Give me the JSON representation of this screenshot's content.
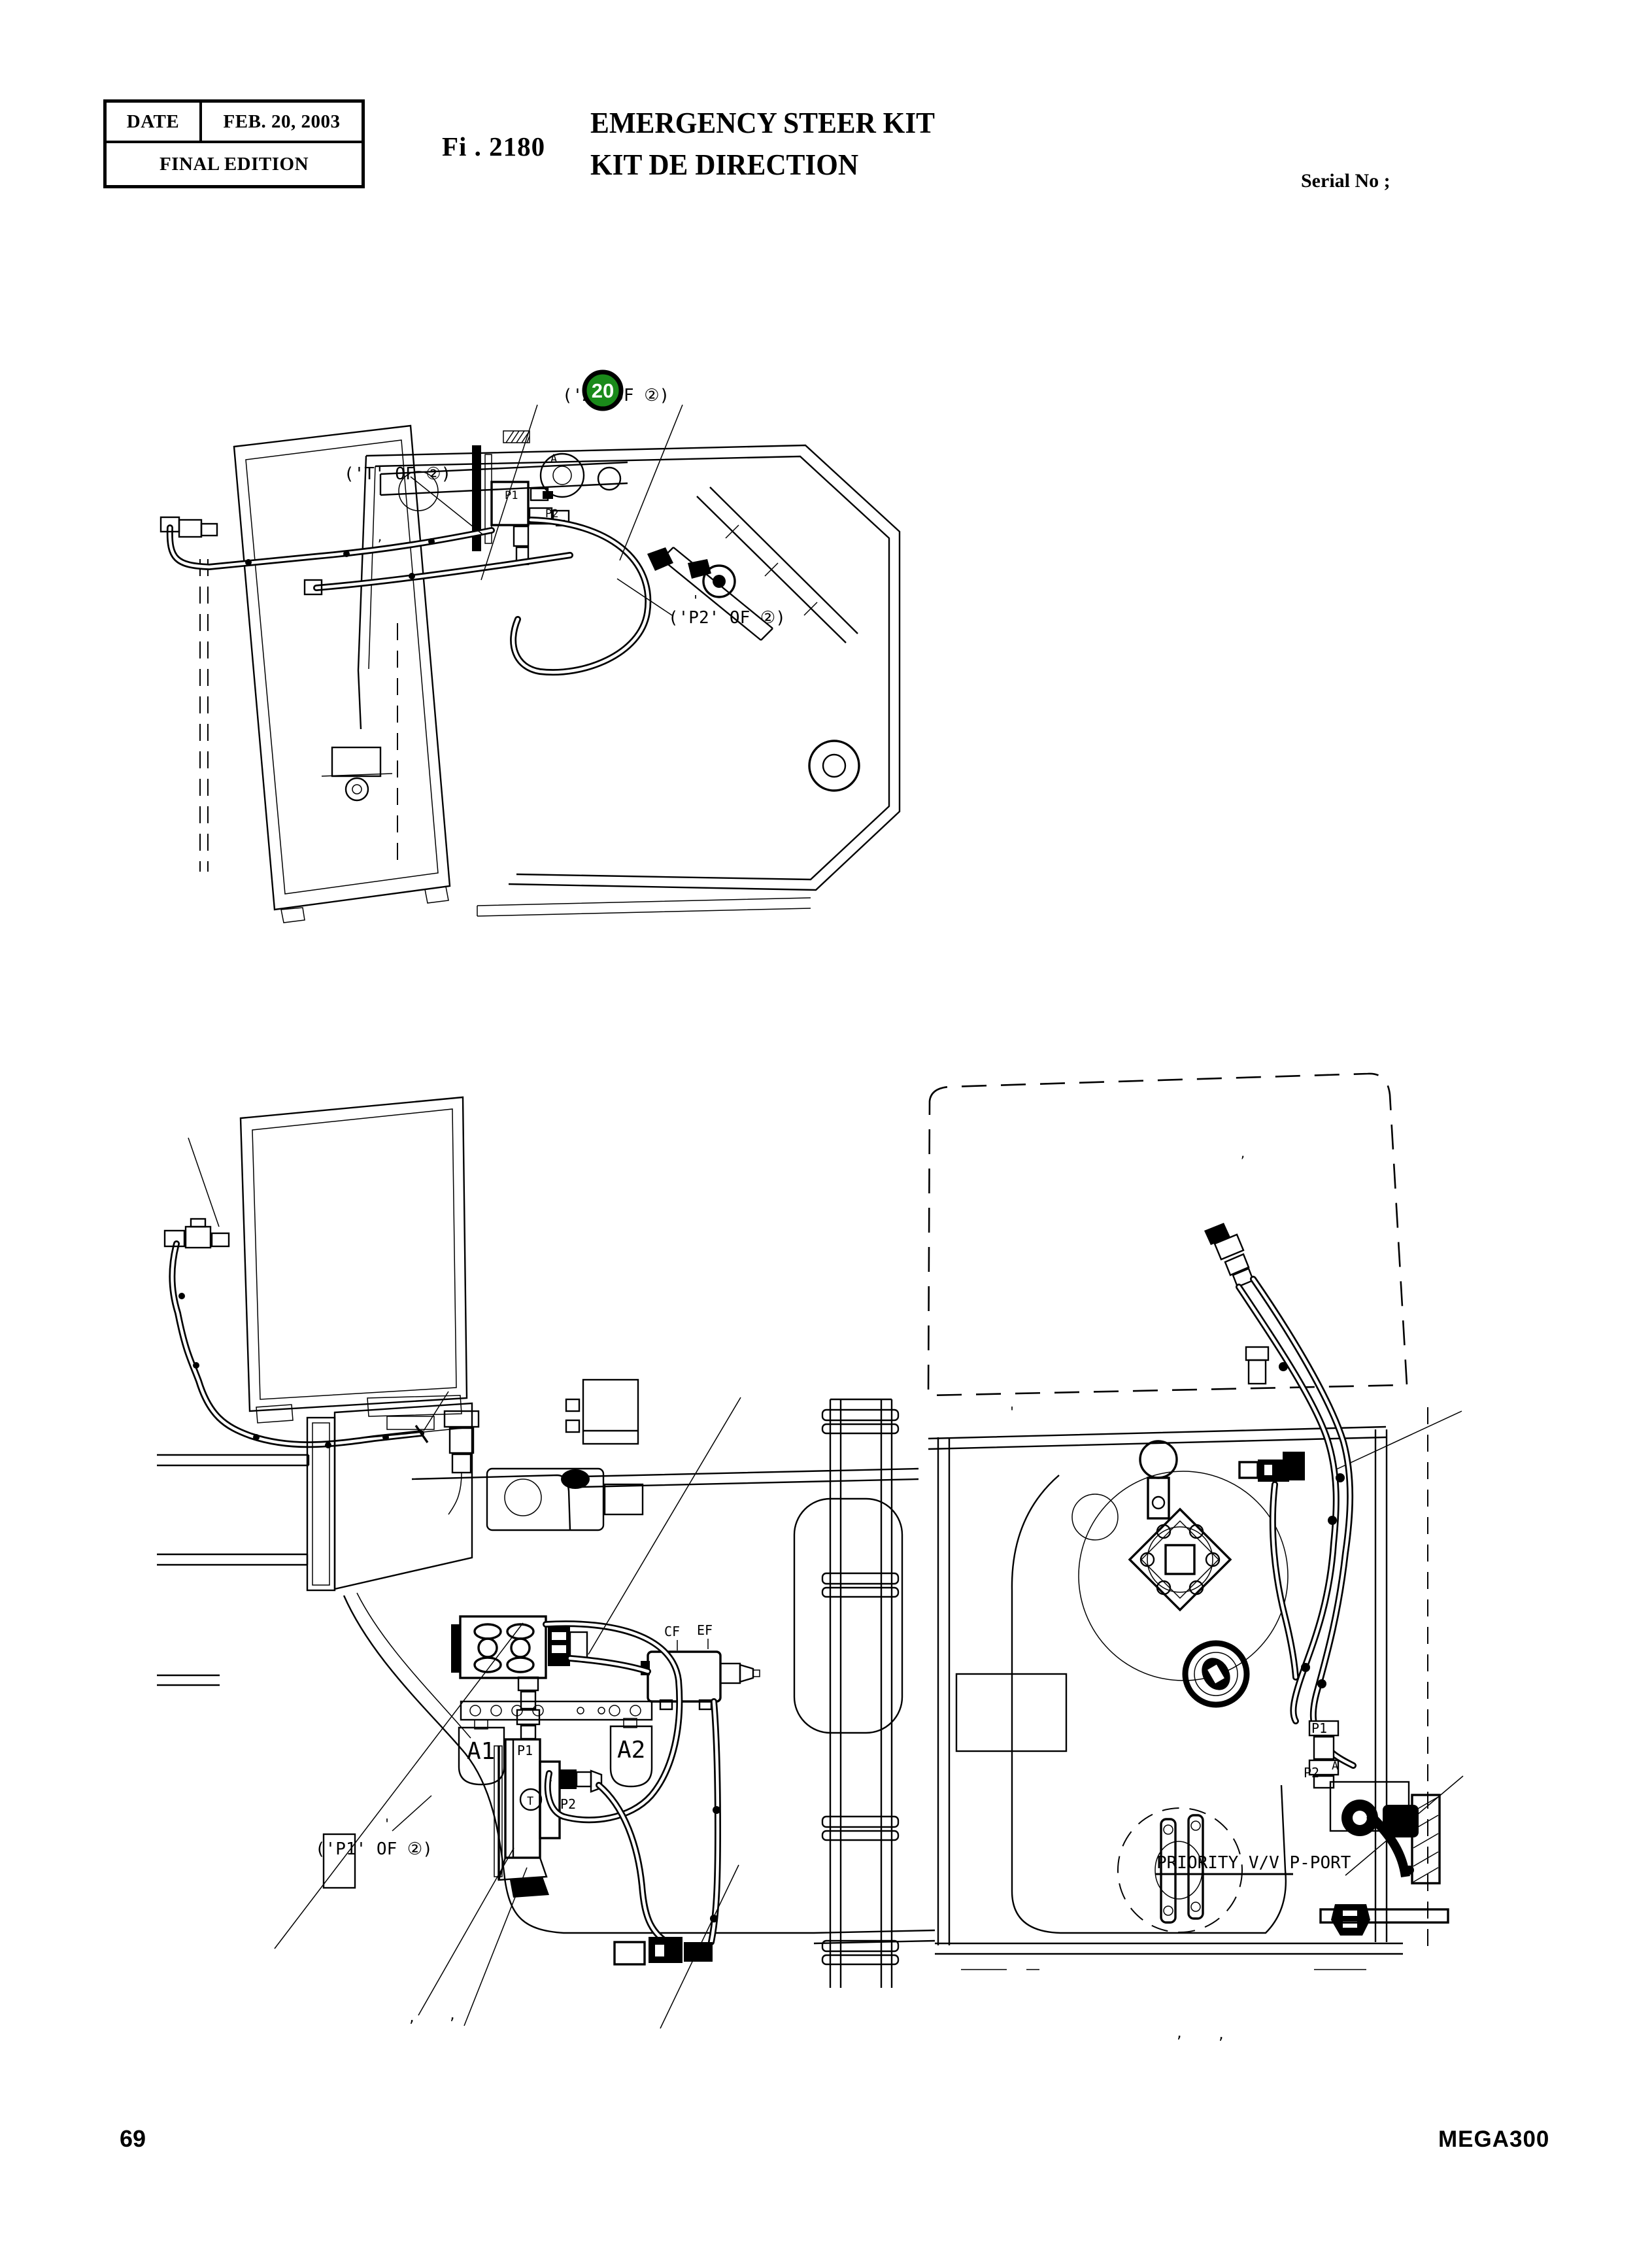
{
  "header": {
    "date_label": "DATE",
    "date_value": "FEB. 20, 2003",
    "edition": "FINAL EDITION",
    "figure_no": "Fi . 2180",
    "title_en": "EMERGENCY STEER KIT",
    "title_fr": "KIT DE DIRECTION",
    "serial": "Serial No ;"
  },
  "footer": {
    "page_number": "69",
    "model": "MEGA300"
  },
  "colors": {
    "badge_green": "#1a8a1a",
    "ink": "#000000",
    "paper": "#ffffff"
  },
  "diagram_top": {
    "badge": "20",
    "callout_a": "('A' OF ②)",
    "callout_t": "('T' OF ②)",
    "callout_p2": "('P2' OF ②)",
    "port_a": "A",
    "port_p1": "P1",
    "port_p2": "P2",
    "tick1": "'",
    "tick2": ","
  },
  "diagram_left": {
    "callout_p1": "('P1' OF ②)",
    "accumulator_1": "A1",
    "accumulator_2": "A2",
    "port_cf": "CF",
    "port_ef": "EF",
    "port_p1": "P1",
    "port_p2": "P2",
    "port_a": "A",
    "port_t": "T",
    "tick1": "'",
    "tick2": ",",
    "tick3": ","
  },
  "diagram_right": {
    "note_priority": "PRIORITY V/V P-PORT",
    "port_p1": "P1",
    "port_p2": "P2",
    "port_a": "A",
    "tick1": "'",
    "tick2": ",",
    "tick3": ",",
    "tick4": ","
  }
}
